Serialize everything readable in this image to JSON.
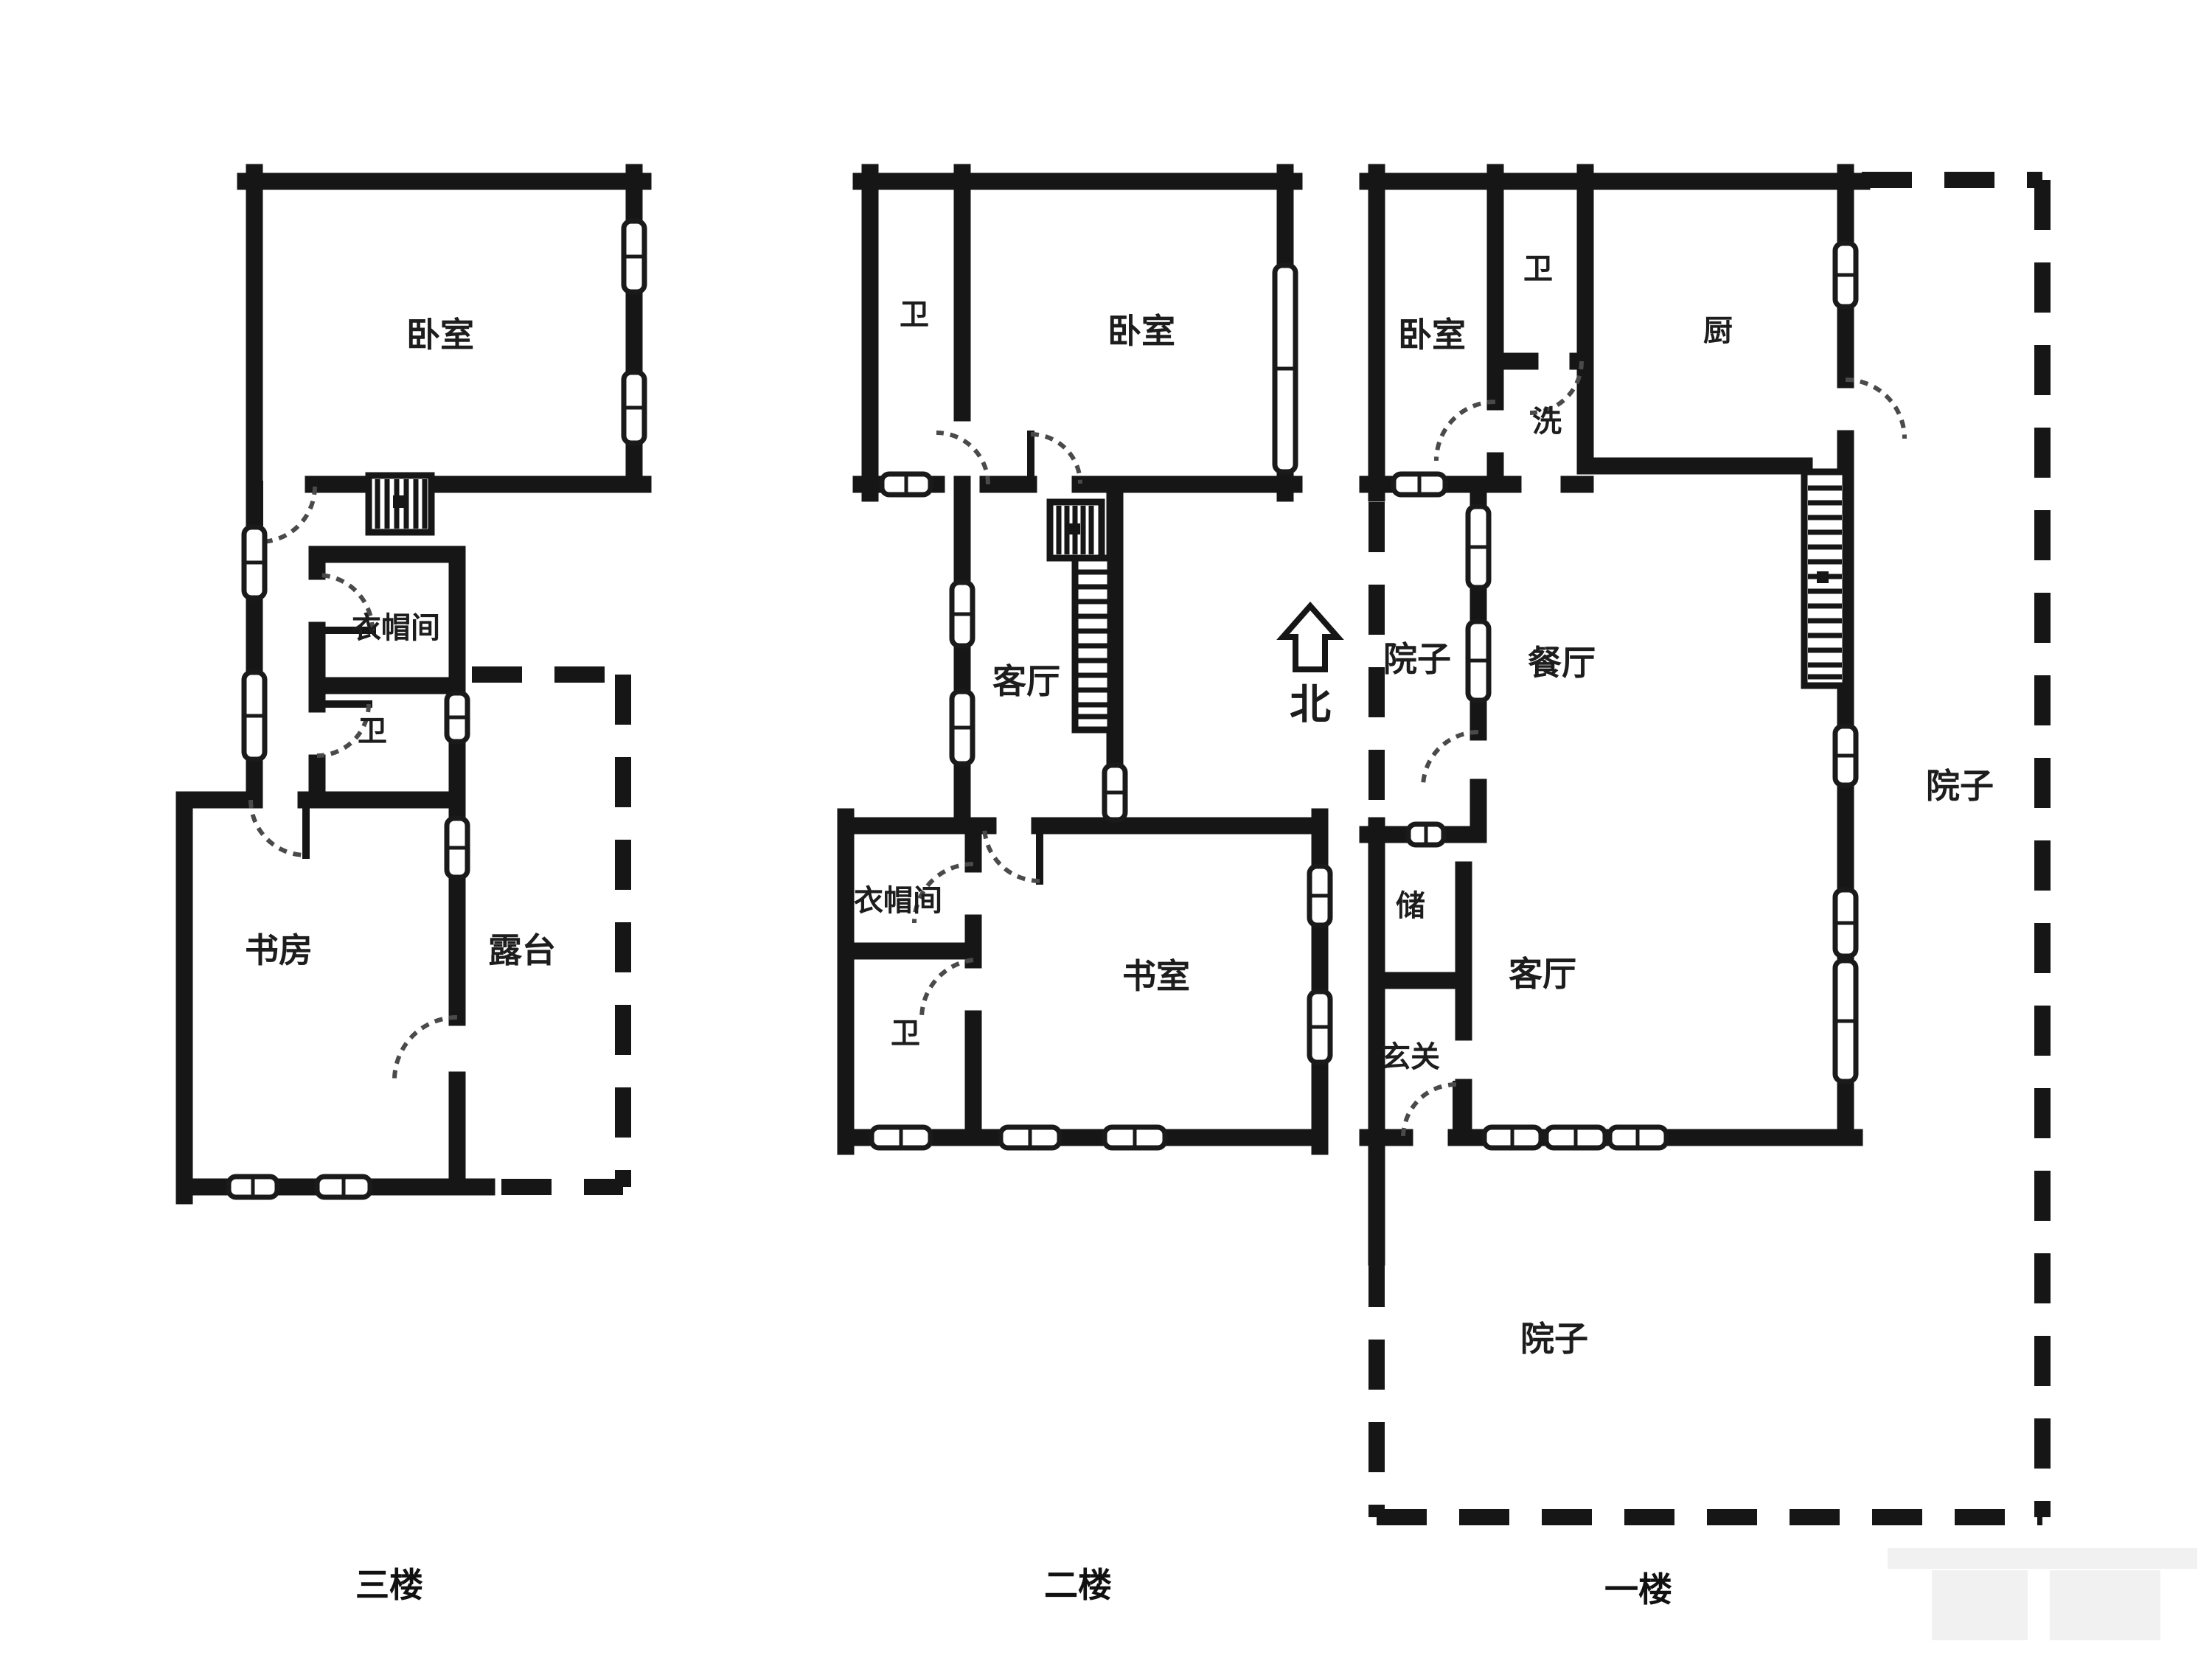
{
  "document": {
    "type": "residential floor plan, 3 levels"
  },
  "colors": {
    "background": "#ffffff",
    "wall": "#161616",
    "label_text": "#1d1d1d",
    "watermark": "#f1f1f1"
  },
  "compass": {
    "label": "北"
  },
  "floors": [
    {
      "caption": "三楼",
      "rooms": {
        "bedroom": "卧室",
        "cloakroom": "衣帽间",
        "bath": "卫",
        "study": "书房",
        "terrace": "露台"
      }
    },
    {
      "caption": "二楼",
      "rooms": {
        "bath_top": "卫",
        "bedroom": "卧室",
        "living": "客厅",
        "cloakroom": "衣帽间",
        "bath_bottom": "卫",
        "study": "书室"
      }
    },
    {
      "caption": "一楼",
      "rooms": {
        "bedroom": "卧室",
        "bath": "卫",
        "wash": "洗",
        "kitchen": "厨",
        "yard_side": "院子",
        "dining": "餐厅",
        "storage": "储",
        "living": "客厅",
        "foyer": "玄关",
        "yard_right": "院子",
        "yard_bottom": "院子"
      }
    }
  ]
}
